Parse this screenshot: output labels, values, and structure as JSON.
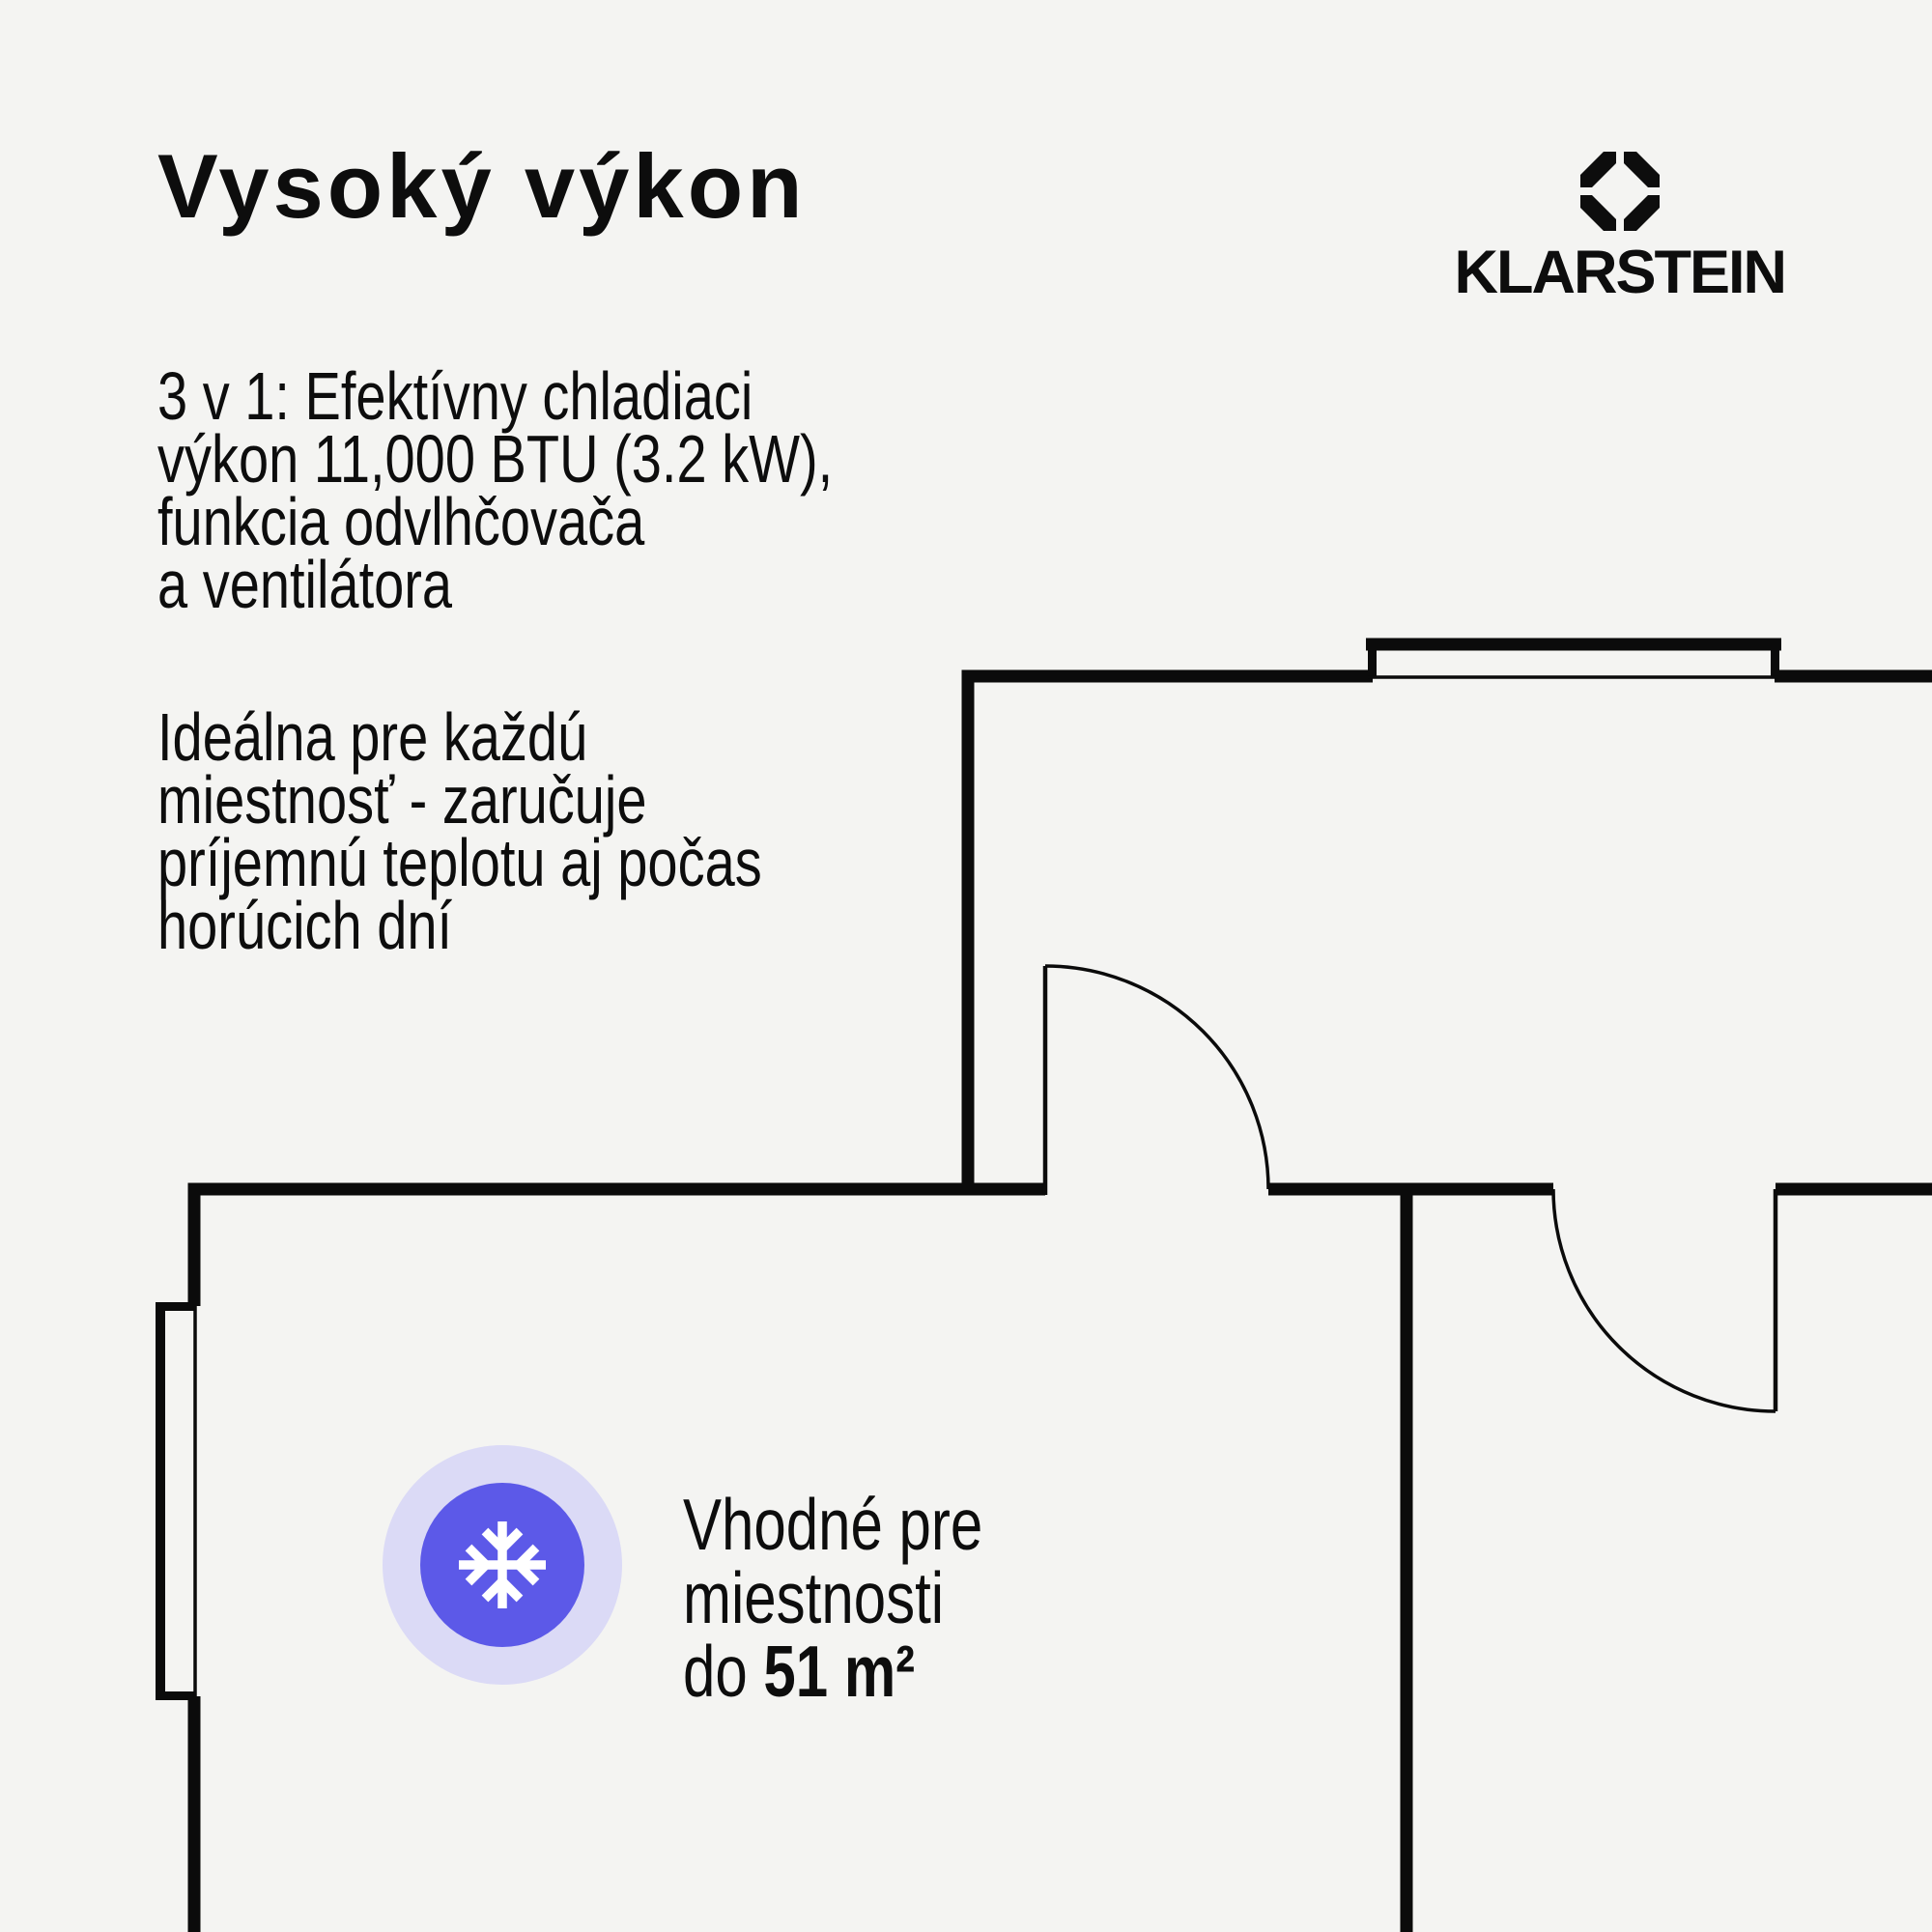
{
  "page": {
    "background_color": "#f4f4f2",
    "ink_color": "#0d0d0d"
  },
  "title": "Vysoký výkon",
  "brand": {
    "wordmark": "KLARSTEIN",
    "logo_icon": "klarstein-octagon-icon",
    "logo_color": "#0d0d0d"
  },
  "intro_paragraph": {
    "lines": [
      "3 v 1: Efektívny chladiaci",
      "výkon 11,000 BTU (3.2 kW),",
      "funkcia odvlhčovača",
      "a ventilátora"
    ]
  },
  "secondary_paragraph": {
    "lines": [
      "Ideálna pre každú",
      "miestnosť - zaručuje",
      "príjemnú teplotu aj počas",
      "horúcich dní"
    ]
  },
  "room_badge": {
    "icon": "snowflake-icon",
    "halo_color": "#dbdaf6",
    "disc_color": "#5c59e8",
    "glyph_color": "#ffffff",
    "caption_line_1": "Vhodné pre",
    "caption_line_2": "miestnosti",
    "caption_line_3_prefix": "do ",
    "caption_line_3_value": "51 m²"
  },
  "floorplan": {
    "line_color": "#0b0b0b",
    "features": "two rooms, top window, left window, two door swings, interior walls"
  }
}
